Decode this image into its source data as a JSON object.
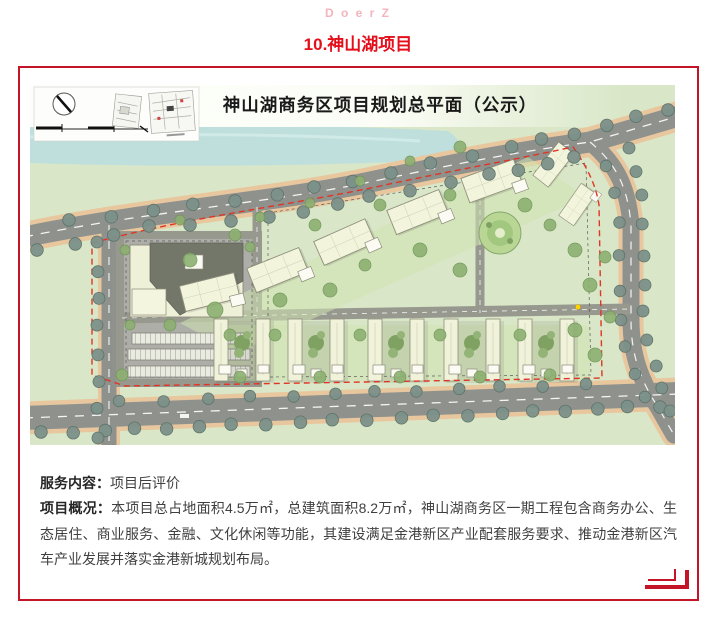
{
  "watermark": "D o e r Z",
  "title": "10.神山湖项目",
  "map": {
    "title": "神山湖商务区项目规划总平面（公示）"
  },
  "article": {
    "service_label": "服务内容：",
    "service_text": "项目后评价",
    "overview_label": "项目概况：",
    "overview_text": "本项目总占地面积4.5万㎡，总建筑面积8.2万㎡，神山湖商务区一期工程包含商务办公、生态居住、商业服务、金融、文化休闲等功能，其建设满足金港新区产业配套服务要求、推动金港新区汽车产业发展并落实金港新城规划布局。"
  },
  "colors": {
    "frame_red": "#c41428",
    "title_red": "#e50e1b",
    "watermark_pink": "#f4b4bc",
    "map_grass": "#d9e7c8",
    "map_water": "#bfdfdd",
    "map_road": "#8f918d",
    "map_building": "#f2f3da",
    "boundary_red": "#e03524"
  }
}
